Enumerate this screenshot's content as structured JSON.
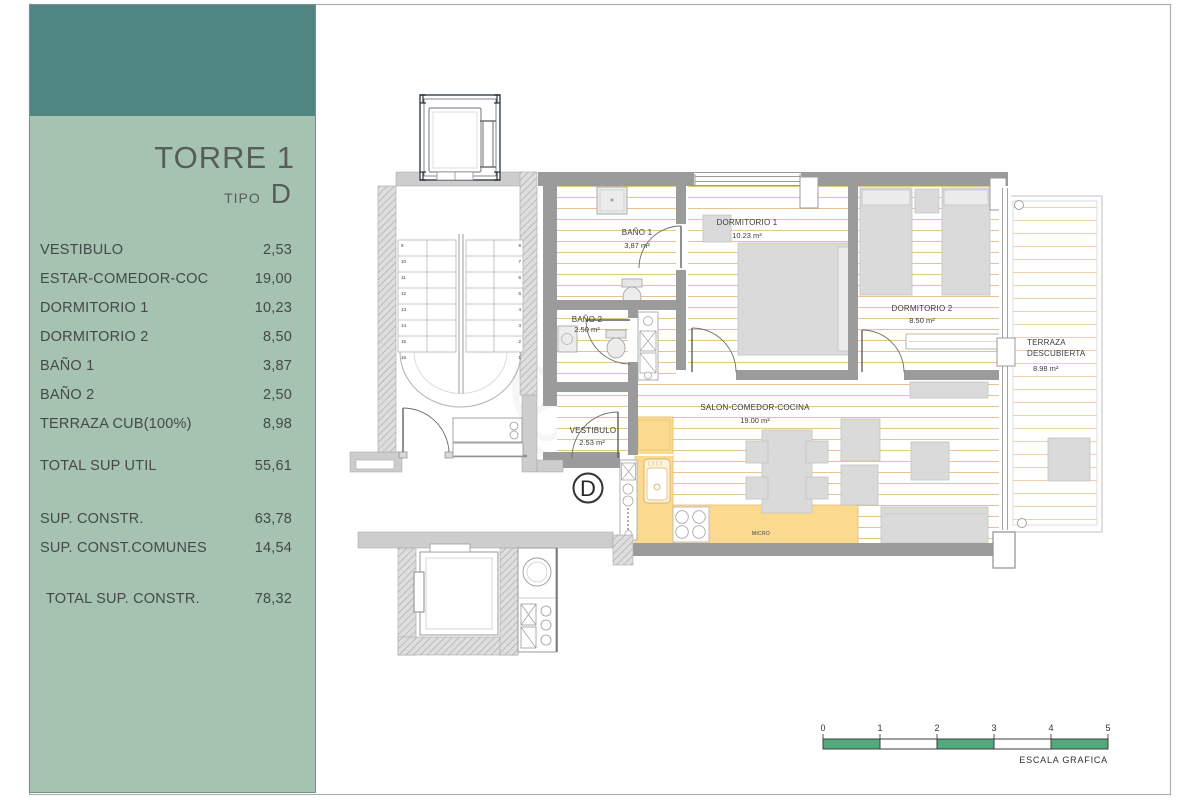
{
  "page": {
    "bg": "#ffffff",
    "frame_color": "#aab0ad"
  },
  "sidebar": {
    "colors": {
      "header_teal": "#4f8682",
      "panel_green": "#a6c2b0",
      "text": "#44494a"
    },
    "title": "TORRE 1",
    "tipo_label": "TIPO",
    "tipo_value": "D",
    "rows": [
      {
        "label": "VESTIBULO",
        "value": "2,53"
      },
      {
        "label": "ESTAR-COMEDOR-COC",
        "value": "19,00"
      },
      {
        "label": "DORMITORIO 1",
        "value": "10,23"
      },
      {
        "label": "DORMITORIO 2",
        "value": "8,50"
      },
      {
        "label": "BAÑO 1",
        "value": "3,87"
      },
      {
        "label": "BAÑO 2",
        "value": "2,50"
      },
      {
        "label": "TERRAZA CUB(100%)",
        "value": "8,98"
      }
    ],
    "totals": [
      {
        "label": "TOTAL SUP UTIL",
        "value": "55,61"
      },
      {
        "label": "SUP. CONSTR.",
        "value": "63,78"
      },
      {
        "label": "SUP. CONST.COMUNES",
        "value": "14,54"
      },
      {
        "label": "TOTAL SUP. CONSTR.",
        "value": "78,32"
      }
    ]
  },
  "plan": {
    "unit_letter": "D",
    "rooms": {
      "bano1": {
        "name": "BAÑO 1",
        "area": "3,87 m²"
      },
      "bano2": {
        "name": "BAÑO 2",
        "area": "2.50 m²"
      },
      "dorm1": {
        "name": "DORMITORIO 1",
        "area": "10.23 m²"
      },
      "dorm2": {
        "name": "DORMITORIO 2",
        "area": "8.50 m²"
      },
      "vestibulo": {
        "name": "VESTIBULO",
        "area": "2.53 m²"
      },
      "salon": {
        "name": "SALON-COMEDOR-COCINA",
        "area": "19.00 m²"
      },
      "terraza": {
        "name_line1": "TERRAZA",
        "name_line2": "DESCUBIERTA",
        "area": "8.98 m²"
      }
    },
    "labels": {
      "micro": "MICRO"
    },
    "stair_numbers": [
      "9",
      "10",
      "11",
      "12",
      "13",
      "14",
      "15",
      "16",
      "8",
      "7",
      "6",
      "5",
      "4",
      "3",
      "2",
      "1"
    ],
    "scale": {
      "ticks": [
        "0",
        "1",
        "2",
        "3",
        "4",
        "5"
      ],
      "caption": "ESCALA GRAFICA",
      "green": "#52a97c"
    },
    "colors": {
      "kitchen_yellow": "#fbda8f",
      "floor_stripe": "#e9c38c",
      "wall_gray": "#9b9b9b"
    }
  }
}
